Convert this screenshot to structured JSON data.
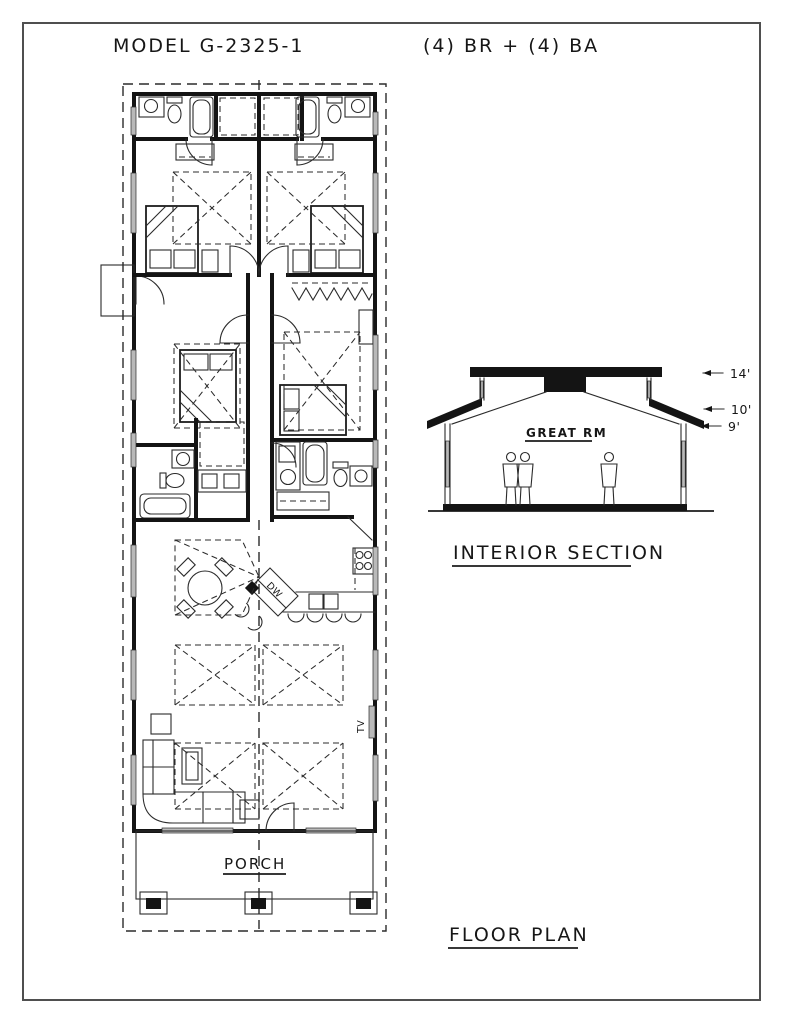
{
  "drawing": {
    "model_title": "MODEL G-2325-1",
    "spec": "(4) BR + (4) BA"
  },
  "floor_plan": {
    "caption": "FLOOR PLAN",
    "labels": {
      "porch": "PORCH",
      "tv": "TV",
      "dishwasher": "DW"
    }
  },
  "interior_section": {
    "caption": "INTERIOR SECTION",
    "room_label": "GREAT RM",
    "height_markers": [
      "14'",
      "10'",
      "9'"
    ]
  },
  "colors": {
    "ink": "#141414",
    "paper": "#ffffff",
    "window_gray": "#b9b9b9"
  }
}
